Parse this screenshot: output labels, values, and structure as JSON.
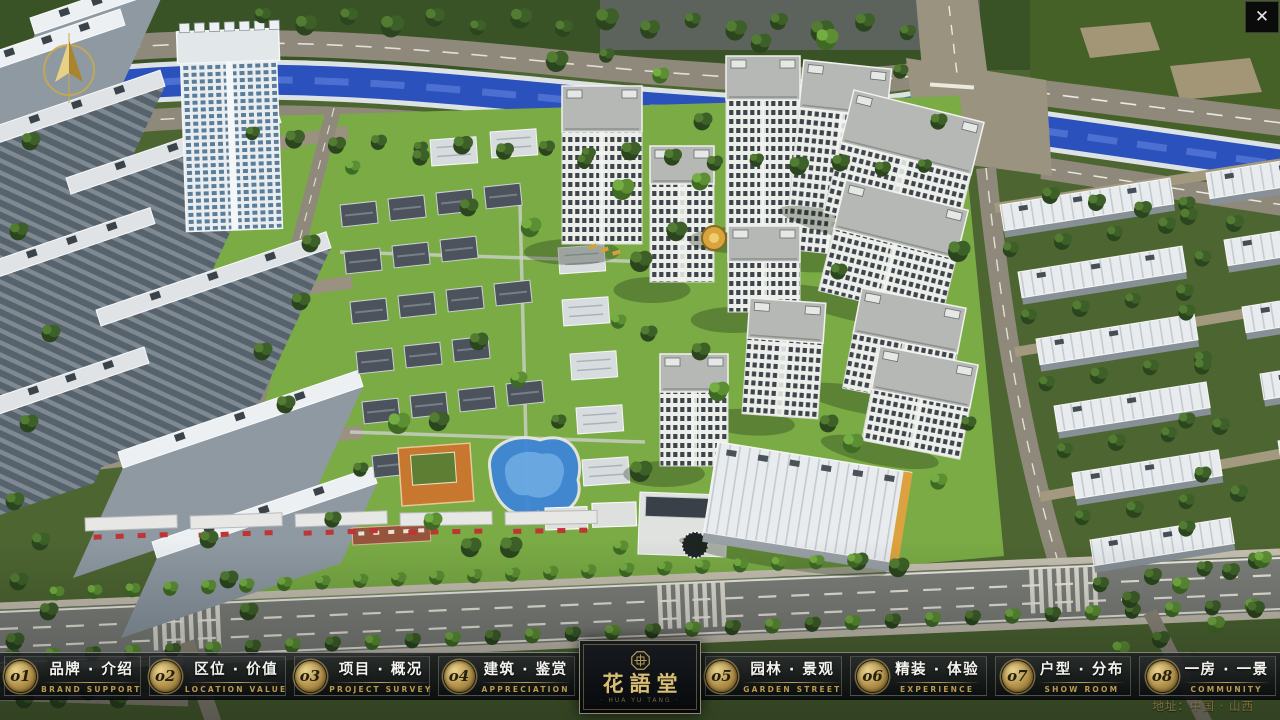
{
  "chrome": {
    "close_label": "✕"
  },
  "nav": {
    "items": [
      {
        "num": "o1",
        "cn": "品牌 · 介绍",
        "en": "BRAND SUPPORT"
      },
      {
        "num": "o2",
        "cn": "区位 · 价值",
        "en": "LOCATION VALUE"
      },
      {
        "num": "o3",
        "cn": "项目 · 概况",
        "en": "PROJECT SURVEY"
      },
      {
        "num": "o4",
        "cn": "建筑 · 鉴赏",
        "en": "APPRECIATION"
      },
      {
        "num": "o5",
        "cn": "园林 · 景观",
        "en": "GARDEN STREET"
      },
      {
        "num": "o6",
        "cn": "精装 · 体验",
        "en": "EXPERIENCE"
      },
      {
        "num": "o7",
        "cn": "户型 · 分布",
        "en": "SHOW ROOM"
      },
      {
        "num": "o8",
        "cn": "一房 · 一景",
        "en": "COMMUNITY"
      }
    ]
  },
  "logo": {
    "title": "花語堂",
    "subtitle": "· HUA YU TANG ·"
  },
  "footer": {
    "address": "地址：中国 · 山西"
  },
  "colors": {
    "accent_gold": "#c9ad5e",
    "bar_bg": "#0b0d0f",
    "river_blue": "#2b51bd",
    "lawn_green": "#7aab45",
    "road_gray": "#8f897b"
  }
}
